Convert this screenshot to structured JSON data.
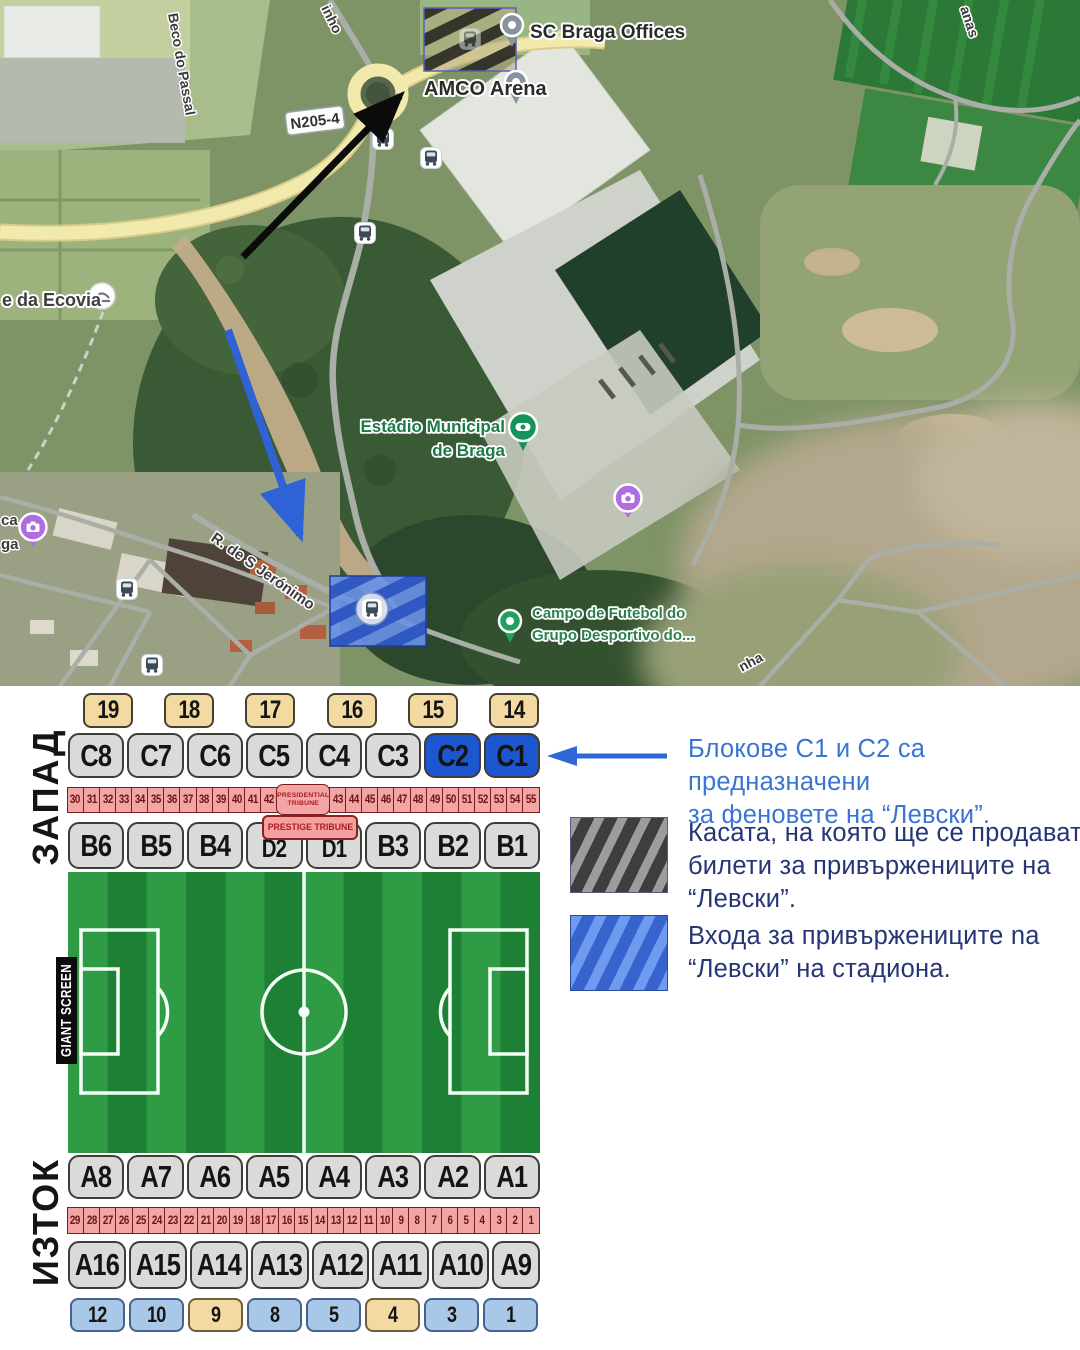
{
  "map": {
    "labels": {
      "sc_braga": "SC Braga Offices",
      "amco": "AMCO Arena",
      "shield": "N205-4",
      "estadio1": "Estádio Municipal",
      "estadio2": "de Braga",
      "campo1": "Campo de Futebol do",
      "campo2": "Grupo Desportivo do...",
      "ecovia": "e da Ecovia",
      "jeronimo": "R. de S Jerónimo",
      "beco": "Beco do Passal",
      "frag_inho": "inho",
      "frag_anas": "anas",
      "frag_nha": "nha",
      "frag_ca": "ca",
      "frag_ga": "ga"
    }
  },
  "chart": {
    "west_label": "ЗАПАД",
    "east_label": "ИЗТОК",
    "giant_screen": "GIANT SCREEN",
    "gates_top": [
      "19",
      "18",
      "17",
      "16",
      "15",
      "14"
    ],
    "row_c": [
      {
        "label": "C8",
        "style": "gray"
      },
      {
        "label": "C7",
        "style": "gray"
      },
      {
        "label": "C6",
        "style": "gray"
      },
      {
        "label": "C5",
        "style": "gray"
      },
      {
        "label": "C4",
        "style": "gray"
      },
      {
        "label": "C3",
        "style": "gray"
      },
      {
        "label": "C2",
        "style": "blue"
      },
      {
        "label": "C1",
        "style": "blue"
      }
    ],
    "strip_top_a": [
      "30",
      "31",
      "32",
      "33",
      "34",
      "35",
      "36",
      "37",
      "38",
      "39",
      "40",
      "41",
      "42"
    ],
    "presidential_line1": "PRESIDENTIAL",
    "presidential_line2": "TRIBUNE",
    "strip_top_b": [
      "43",
      "44",
      "45",
      "46",
      "47",
      "48",
      "49",
      "50",
      "51",
      "52",
      "53",
      "54",
      "55"
    ],
    "prestige_tribune": "PRESTIGE TRIBUNE",
    "row_b": [
      {
        "label": "B6",
        "style": "b"
      },
      {
        "label": "B5",
        "style": "b"
      },
      {
        "label": "B4",
        "style": "b"
      },
      {
        "label": "D2",
        "style": "d"
      },
      {
        "label": "D1",
        "style": "d"
      },
      {
        "label": "B3",
        "style": "b"
      },
      {
        "label": "B2",
        "style": "b"
      },
      {
        "label": "B1",
        "style": "b"
      }
    ],
    "row_a_upper": [
      "A8",
      "A7",
      "A6",
      "A5",
      "A4",
      "A3",
      "A2",
      "A1"
    ],
    "strip_bottom": [
      "29",
      "28",
      "27",
      "26",
      "25",
      "24",
      "23",
      "22",
      "21",
      "20",
      "19",
      "18",
      "17",
      "16",
      "15",
      "14",
      "13",
      "12",
      "11",
      "10",
      "9",
      "8",
      "7",
      "6",
      "5",
      "4",
      "3",
      "2",
      "1"
    ],
    "row_a_lower": [
      "A16",
      "A15",
      "A14",
      "A13",
      "A12",
      "A11",
      "A10",
      "A9"
    ],
    "gates_bottom": [
      {
        "label": "12",
        "style": "blue"
      },
      {
        "label": "10",
        "style": "blue"
      },
      {
        "label": "9",
        "style": "tan"
      },
      {
        "label": "8",
        "style": "blue"
      },
      {
        "label": "5",
        "style": "blue"
      },
      {
        "label": "4",
        "style": "tan"
      },
      {
        "label": "3",
        "style": "blue"
      },
      {
        "label": "1",
        "style": "blue"
      }
    ]
  },
  "legend": {
    "item1": "Блокове С1 и С2 са предназначени\nза феновете на “Левски”.",
    "item2": "Касата, на която ще се продават\nбилети за привържениците на\n“Левски”.",
    "item3": "Входа за привържениците na\n“Левски” на стадиона."
  },
  "colors": {
    "accent_blue": "#2e68d6",
    "sector_blue": "#1c57cf",
    "gate_tan": "#f3d9a2",
    "gate_light_blue": "#a9c8e8",
    "strip_pink": "#f2a5a5",
    "strip_red": "#7c1d1d",
    "pitch_green_light": "#2f9b45",
    "pitch_green_dark": "#1d8034",
    "legend_blue_text": "#3a74d4",
    "legend_navy_text": "#263575"
  }
}
